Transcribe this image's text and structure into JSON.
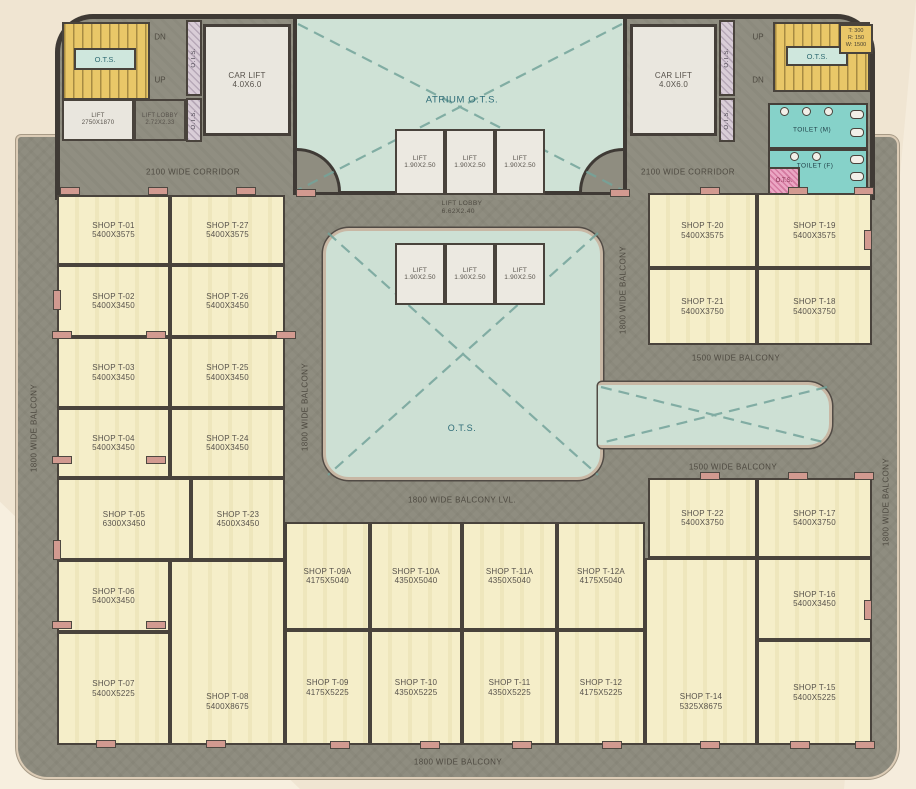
{
  "colors": {
    "paper_background": "#f0e5d2",
    "corridor_grey": "#8f8d80",
    "shop_fill": "#f4edc6",
    "atrium_teal": "#cfe2d6",
    "stair_yellow": "#e9c768",
    "toilet_teal": "#86d2c9",
    "column_pink": "#d29a90",
    "wall_dark": "#3f3a35"
  },
  "labels": {
    "atrium_ots": "ATRIUM O.T.S.",
    "ots": "O.T.S.",
    "corridor_2100": "2100 WIDE CORRIDOR",
    "balcony_1800": "1800 WIDE BALCONY",
    "balcony_1800_lvl": "1800 WIDE BALCONY LVL.",
    "balcony_1500": "1500 WIDE BALCONY",
    "lift_lobby_top": {
      "name": "LIFT LOBBY",
      "dims": "2.72X2.33"
    },
    "lift_lobby_central": {
      "name": "LIFT LOBBY",
      "dims": "6.62X2.40"
    },
    "lift_main": {
      "name": "LIFT",
      "dims": "2750X1870"
    },
    "lift_small": {
      "name": "LIFT",
      "dims": "1.90X2.50"
    },
    "car_lift": {
      "name": "CAR LIFT",
      "dims": "4.0X6.0"
    },
    "toilet_m": "TOILET (M)",
    "toilet_f": "TOILET (F)",
    "up": "UP",
    "dn": "DN",
    "stair_legend": {
      "tread": "T: 300",
      "riser": "R: 150",
      "width": "W: 1500"
    }
  },
  "shops": {
    "t01": {
      "name": "SHOP T-01",
      "dims": "5400X3575"
    },
    "t02": {
      "name": "SHOP T-02",
      "dims": "5400X3450"
    },
    "t03": {
      "name": "SHOP T-03",
      "dims": "5400X3450"
    },
    "t04": {
      "name": "SHOP T-04",
      "dims": "5400X3450"
    },
    "t05": {
      "name": "SHOP T-05",
      "dims": "6300X3450"
    },
    "t06": {
      "name": "SHOP T-06",
      "dims": "5400X3450"
    },
    "t07": {
      "name": "SHOP T-07",
      "dims": "5400X5225"
    },
    "t08": {
      "name": "SHOP T-08",
      "dims": "5400X8675"
    },
    "t09a": {
      "name": "SHOP T-09A",
      "dims": "4175X5040"
    },
    "t10a": {
      "name": "SHOP T-10A",
      "dims": "4350X5040"
    },
    "t11a": {
      "name": "SHOP T-11A",
      "dims": "4350X5040"
    },
    "t12a": {
      "name": "SHOP T-12A",
      "dims": "4175X5040"
    },
    "t09": {
      "name": "SHOP T-09",
      "dims": "4175X5225"
    },
    "t10": {
      "name": "SHOP T-10",
      "dims": "4350X5225"
    },
    "t11": {
      "name": "SHOP T-11",
      "dims": "4350X5225"
    },
    "t12": {
      "name": "SHOP T-12",
      "dims": "4175X5225"
    },
    "t14": {
      "name": "SHOP T-14",
      "dims": "5325X8675"
    },
    "t15": {
      "name": "SHOP T-15",
      "dims": "5400X5225"
    },
    "t16": {
      "name": "SHOP T-16",
      "dims": "5400X3450"
    },
    "t17": {
      "name": "SHOP T-17",
      "dims": "5400X3750"
    },
    "t18": {
      "name": "SHOP T-18",
      "dims": "5400X3750"
    },
    "t19": {
      "name": "SHOP T-19",
      "dims": "5400X3575"
    },
    "t20": {
      "name": "SHOP T-20",
      "dims": "5400X3575"
    },
    "t21": {
      "name": "SHOP T-21",
      "dims": "5400X3750"
    },
    "t22": {
      "name": "SHOP T-22",
      "dims": "5400X3750"
    },
    "t23": {
      "name": "SHOP T-23",
      "dims": "4500X3450"
    },
    "t24": {
      "name": "SHOP T-24",
      "dims": "5400X3450"
    },
    "t25": {
      "name": "SHOP T-25",
      "dims": "5400X3450"
    },
    "t26": {
      "name": "SHOP T-26",
      "dims": "5400X3450"
    },
    "t27": {
      "name": "SHOP T-27",
      "dims": "5400X3575"
    }
  }
}
